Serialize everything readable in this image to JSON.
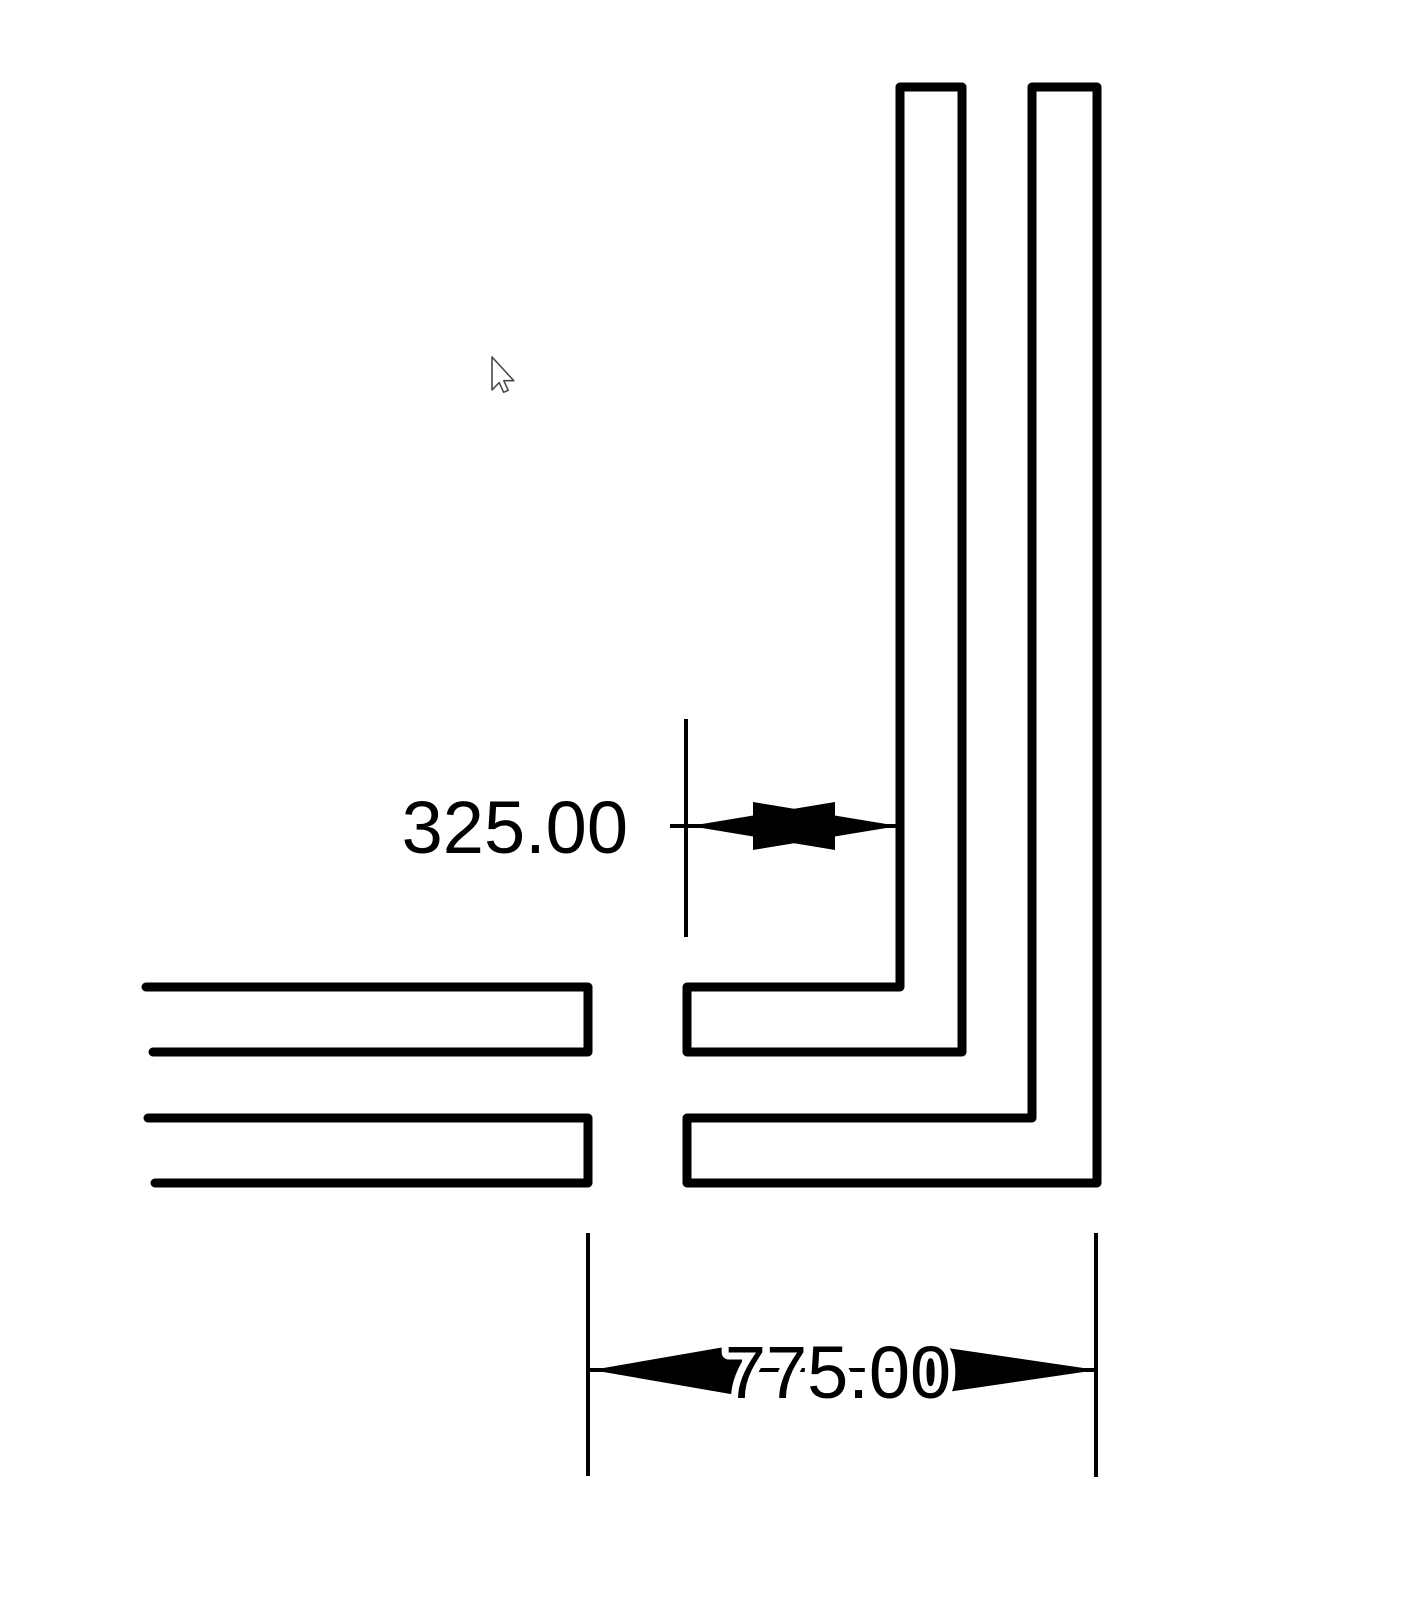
{
  "canvas": {
    "width": 1402,
    "height": 1600,
    "background_color": "#ffffff",
    "line_color": "#000000",
    "wall_stroke_width": 9,
    "dim_stroke_width": 4,
    "label_font_size": 74,
    "label_color": "#000000",
    "label_halo_color": "#ffffff"
  },
  "walls": [
    {
      "name": "wall-right-inner-L",
      "closed": true,
      "points": [
        [
          900,
          87
        ],
        [
          962,
          87
        ],
        [
          962,
          1052
        ],
        [
          687,
          1052
        ],
        [
          687,
          987
        ],
        [
          900,
          987
        ]
      ]
    },
    {
      "name": "wall-right-outer-L",
      "closed": true,
      "points": [
        [
          1032,
          87
        ],
        [
          1097,
          87
        ],
        [
          1097,
          1183
        ],
        [
          687,
          1183
        ],
        [
          687,
          1118
        ],
        [
          1032,
          1118
        ]
      ]
    },
    {
      "name": "wall-left-upper",
      "closed": false,
      "points": [
        [
          146,
          987
        ],
        [
          588,
          987
        ],
        [
          588,
          1052
        ],
        [
          153,
          1052
        ]
      ]
    },
    {
      "name": "wall-left-lower",
      "closed": false,
      "points": [
        [
          148,
          1118
        ],
        [
          588,
          1118
        ],
        [
          588,
          1183
        ],
        [
          155,
          1183
        ]
      ]
    }
  ],
  "dimensions": [
    {
      "label": "325.00",
      "value": 325.0,
      "orientation": "horizontal",
      "extension_lines": [
        {
          "x": 686,
          "y1": 719,
          "y2": 937
        }
      ],
      "dim_line": {
        "y": 826,
        "x1": 670,
        "x2": 898
      },
      "arrowheads": [
        {
          "points": "690,826 835,802 835,850"
        },
        {
          "points": "898,826 753,802 753,850"
        }
      ],
      "text": {
        "x": 628,
        "baseline_y": 853,
        "anchor": "end",
        "halo": false
      }
    },
    {
      "label": "775.00",
      "value": 775.0,
      "orientation": "horizontal",
      "extension_lines": [
        {
          "x": 588,
          "y1": 1233,
          "y2": 1476
        },
        {
          "x": 1096,
          "y1": 1233,
          "y2": 1477
        }
      ],
      "dim_line": {
        "y": 1370,
        "x1": 586,
        "x2": 1098
      },
      "arrowheads": [
        {
          "points": "592,1370 742,1344 742,1396"
        },
        {
          "points": "1097,1370 920,1344 920,1396"
        }
      ],
      "text": {
        "x": 838,
        "baseline_y": 1398,
        "anchor": "middle",
        "halo": true
      }
    }
  ],
  "cursor": {
    "type": "arrow-pointer",
    "tip_x": 492,
    "tip_y": 357,
    "fill": "#ffffff",
    "outline": "#4a4a4a"
  }
}
